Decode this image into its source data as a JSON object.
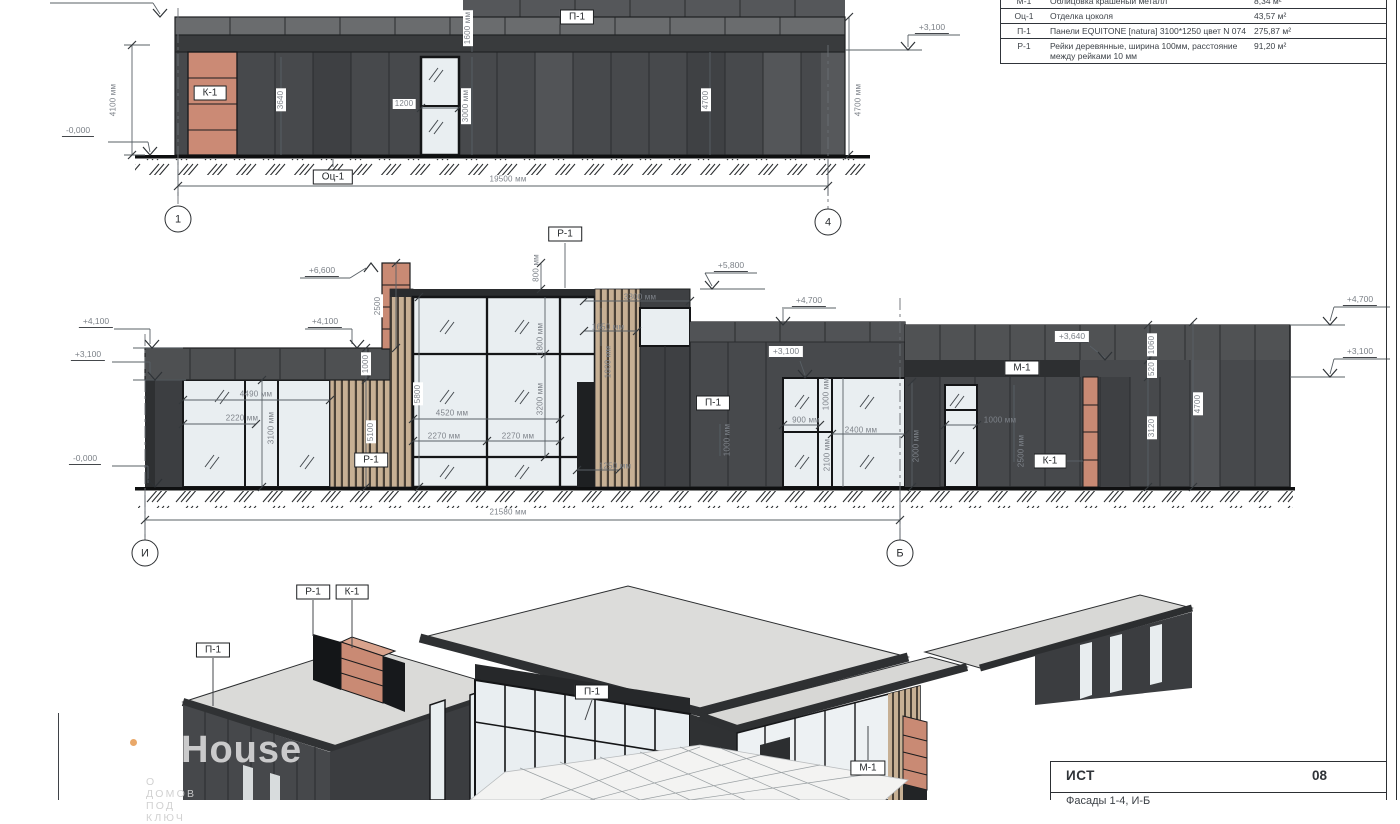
{
  "materials_table": {
    "rows": [
      {
        "code": "М-1",
        "desc": "Облицовка крашеный металл",
        "area": "8,34 м²"
      },
      {
        "code": "Оц-1",
        "desc": "Отделка цоколя",
        "area": "43,57 м²"
      },
      {
        "code": "П-1",
        "desc": "Панели EQUITONE [natura] 3100*1250 цвет N 074",
        "area": "275,87 м²"
      },
      {
        "code": "Р-1",
        "desc": "Рейки деревянные, ширина 100мм, расстояние между рейками 10 мм",
        "area": "91,20 м²"
      }
    ]
  },
  "elevation_top": {
    "annotations": [
      {
        "t": "К-1",
        "x": 210,
        "y": 93,
        "k": "tag"
      },
      {
        "t": "П-1",
        "x": 577,
        "y": 17,
        "k": "tag"
      },
      {
        "t": "Оц-1",
        "x": 333,
        "y": 177,
        "k": "tag"
      },
      {
        "t": "4100 мм",
        "x": 113,
        "y": 100,
        "k": "v"
      },
      {
        "t": "3640",
        "x": 281,
        "y": 100,
        "k": "vb"
      },
      {
        "t": "1200",
        "x": 404,
        "y": 104,
        "k": "hb"
      },
      {
        "t": "3000 мм",
        "x": 466,
        "y": 106,
        "k": "vb"
      },
      {
        "t": "1600 мм",
        "x": 468,
        "y": 28,
        "k": "vb"
      },
      {
        "t": "4700",
        "x": 706,
        "y": 100,
        "k": "vb"
      },
      {
        "t": "4700 мм",
        "x": 858,
        "y": 100,
        "k": "v"
      },
      {
        "t": "19500 мм",
        "x": 508,
        "y": 179,
        "k": "h"
      },
      {
        "t": "-0,000",
        "x": 78,
        "y": 131,
        "k": "lvl"
      },
      {
        "t": "+3,100",
        "x": 932,
        "y": 28,
        "k": "lvl"
      },
      {
        "t": "1",
        "x": 178,
        "y": 219,
        "k": "grid"
      },
      {
        "t": "4",
        "x": 828,
        "y": 222,
        "k": "grid"
      }
    ]
  },
  "elevation_mid": {
    "annotations": [
      {
        "t": "Р-1",
        "x": 565,
        "y": 234,
        "k": "tag"
      },
      {
        "t": "Р-1",
        "x": 371,
        "y": 460,
        "k": "tag"
      },
      {
        "t": "П-1",
        "x": 713,
        "y": 403,
        "k": "tag"
      },
      {
        "t": "М-1",
        "x": 1022,
        "y": 368,
        "k": "tag"
      },
      {
        "t": "К-1",
        "x": 1050,
        "y": 461,
        "k": "tag"
      },
      {
        "t": "+6,600",
        "x": 322,
        "y": 271,
        "k": "lvl"
      },
      {
        "t": "+4,100",
        "x": 96,
        "y": 322,
        "k": "lvl"
      },
      {
        "t": "+3,100",
        "x": 88,
        "y": 355,
        "k": "lvl"
      },
      {
        "t": "-0,000",
        "x": 85,
        "y": 459,
        "k": "lvl"
      },
      {
        "t": "+4,100",
        "x": 325,
        "y": 322,
        "k": "lvl"
      },
      {
        "t": "+5,800",
        "x": 731,
        "y": 266,
        "k": "lvl"
      },
      {
        "t": "+4,700",
        "x": 809,
        "y": 301,
        "k": "lvl"
      },
      {
        "t": "+3,100",
        "x": 786,
        "y": 352,
        "k": "lvlb"
      },
      {
        "t": "+3,640",
        "x": 1072,
        "y": 337,
        "k": "lvlb"
      },
      {
        "t": "+4,700",
        "x": 1360,
        "y": 300,
        "k": "lvl"
      },
      {
        "t": "+3,100",
        "x": 1360,
        "y": 352,
        "k": "lvl"
      },
      {
        "t": "4490 мм",
        "x": 256,
        "y": 394,
        "k": "h"
      },
      {
        "t": "2220 мм",
        "x": 242,
        "y": 418,
        "k": "h"
      },
      {
        "t": "3100 мм",
        "x": 271,
        "y": 428,
        "k": "v"
      },
      {
        "t": "1000",
        "x": 366,
        "y": 364,
        "k": "vb"
      },
      {
        "t": "5100",
        "x": 371,
        "y": 432,
        "k": "vb"
      },
      {
        "t": "2500",
        "x": 378,
        "y": 306,
        "k": "vb"
      },
      {
        "t": "800 мм",
        "x": 536,
        "y": 268,
        "k": "v"
      },
      {
        "t": "1800 мм",
        "x": 540,
        "y": 339,
        "k": "v"
      },
      {
        "t": "3200 мм",
        "x": 540,
        "y": 399,
        "k": "v"
      },
      {
        "t": "5800",
        "x": 418,
        "y": 394,
        "k": "vb"
      },
      {
        "t": "4520 мм",
        "x": 452,
        "y": 413,
        "k": "h"
      },
      {
        "t": "2270 мм",
        "x": 444,
        "y": 436,
        "k": "h"
      },
      {
        "t": "2270 мм",
        "x": 518,
        "y": 436,
        "k": "h"
      },
      {
        "t": "3300 мм",
        "x": 640,
        "y": 297,
        "k": "h"
      },
      {
        "t": "1650 мм",
        "x": 608,
        "y": 327,
        "k": "h"
      },
      {
        "t": "1250 мм",
        "x": 615,
        "y": 466,
        "k": "h"
      },
      {
        "t": "1000 мм",
        "x": 608,
        "y": 362,
        "k": "v"
      },
      {
        "t": "1000 мм",
        "x": 727,
        "y": 440,
        "k": "v"
      },
      {
        "t": "900 мм",
        "x": 806,
        "y": 420,
        "k": "h"
      },
      {
        "t": "2400 мм",
        "x": 861,
        "y": 430,
        "k": "h"
      },
      {
        "t": "1000 мм",
        "x": 826,
        "y": 394,
        "k": "v"
      },
      {
        "t": "2100 мм",
        "x": 827,
        "y": 455,
        "k": "v"
      },
      {
        "t": "2000 мм",
        "x": 916,
        "y": 446,
        "k": "v"
      },
      {
        "t": "1000 мм",
        "x": 1000,
        "y": 420,
        "k": "h"
      },
      {
        "t": "2500 мм",
        "x": 1021,
        "y": 451,
        "k": "v"
      },
      {
        "t": "1060",
        "x": 1152,
        "y": 345,
        "k": "vb"
      },
      {
        "t": "520",
        "x": 1152,
        "y": 369,
        "k": "vb"
      },
      {
        "t": "3120",
        "x": 1152,
        "y": 428,
        "k": "vb"
      },
      {
        "t": "4700",
        "x": 1198,
        "y": 404,
        "k": "vb"
      },
      {
        "t": "21580 мм",
        "x": 508,
        "y": 512,
        "k": "h"
      },
      {
        "t": "И",
        "x": 145,
        "y": 553,
        "k": "grid"
      },
      {
        "t": "Б",
        "x": 900,
        "y": 553,
        "k": "grid"
      }
    ]
  },
  "view_3d": {
    "annotations": [
      {
        "t": "П-1",
        "x": 213,
        "y": 650,
        "k": "tag"
      },
      {
        "t": "Р-1",
        "x": 313,
        "y": 592,
        "k": "tag"
      },
      {
        "t": "К-1",
        "x": 352,
        "y": 592,
        "k": "tag"
      },
      {
        "t": "П-1",
        "x": 592,
        "y": 692,
        "k": "tag"
      },
      {
        "t": "М-1",
        "x": 868,
        "y": 768,
        "k": "tag"
      }
    ]
  },
  "titleblock": {
    "project_code": "ИСТ",
    "sheet_number": "08",
    "bottom_row": "Фасады 1-4, И-Б"
  },
  "watermark": {
    "brand": "House",
    "tagline": "О ДОМОВ ПОД КЛЮЧ"
  }
}
